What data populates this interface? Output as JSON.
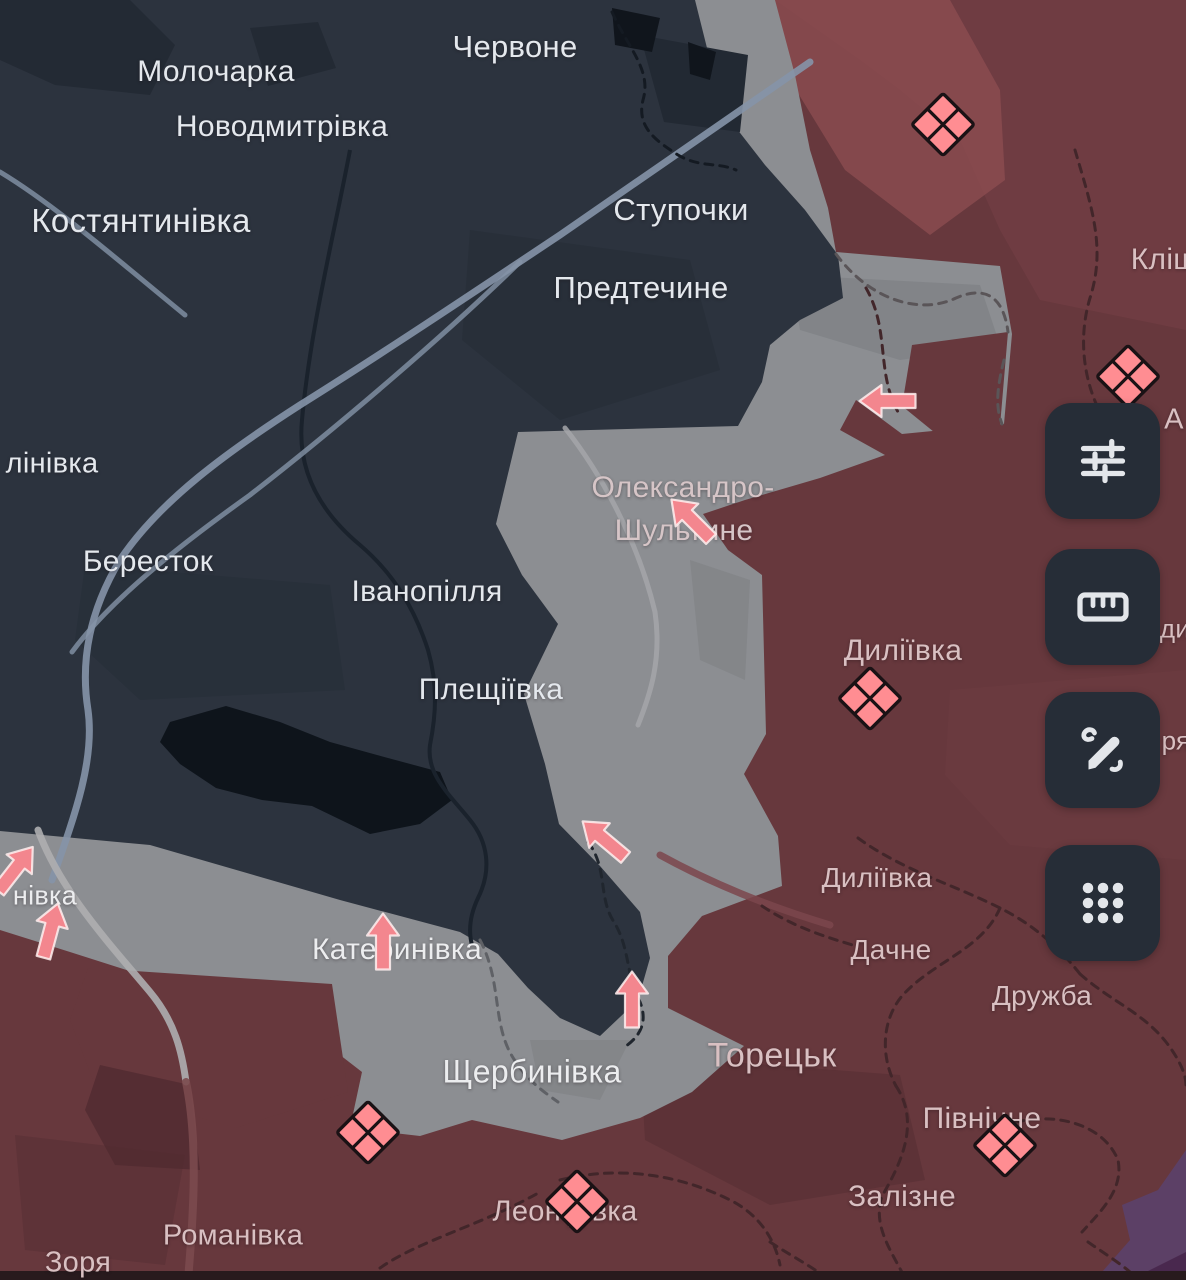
{
  "map": {
    "colors": {
      "ukraine_controlled_navy": "#2c333e",
      "contested_gray": "#8c8e92",
      "russia_controlled_red": "#67383d",
      "recent_advance_red": "#8d4e52",
      "marker_pink": "#ff8d92",
      "marker_outline": "#1a1215",
      "arrow_pink": "#f3868e",
      "purple_region": "#5c4066",
      "button_background": "#262d37",
      "icon_color": "#e3e6ea",
      "road_light": "#8593a8"
    },
    "labels": [
      {
        "name": "chervone",
        "text": "Червоне",
        "x": 515,
        "y": 47,
        "size": 31,
        "tone": "navy"
      },
      {
        "name": "molocharka",
        "text": "Молочарка",
        "x": 216,
        "y": 72,
        "size": 30,
        "tone": "navy"
      },
      {
        "name": "novodmytrivka",
        "text": "Новодмитрівка",
        "x": 282,
        "y": 127,
        "size": 30,
        "tone": "navy"
      },
      {
        "name": "kostiantynivka",
        "text": "Костянтинівка",
        "x": 141,
        "y": 221,
        "size": 33,
        "tone": "navy"
      },
      {
        "name": "stupochky",
        "text": "Ступочки",
        "x": 681,
        "y": 210,
        "size": 31,
        "tone": "navy"
      },
      {
        "name": "predtechyne",
        "text": "Предтечине",
        "x": 641,
        "y": 288,
        "size": 31,
        "tone": "navy"
      },
      {
        "name": "klishchiivka-partial",
        "text": "Кліщі",
        "x": 1168,
        "y": 260,
        "size": 30,
        "tone": "red"
      },
      {
        "name": "kalinivka-partial",
        "text": "лінівка",
        "x": 52,
        "y": 464,
        "size": 29,
        "tone": "navy"
      },
      {
        "name": "berestok",
        "text": "Бересток",
        "x": 148,
        "y": 562,
        "size": 30,
        "tone": "navy"
      },
      {
        "name": "ivanopillia",
        "text": "Іванопілля",
        "x": 427,
        "y": 592,
        "size": 30,
        "tone": "navy"
      },
      {
        "name": "oleksandro-shultyne-line1",
        "text": "Олександро-",
        "x": 683,
        "y": 488,
        "size": 30,
        "tone": "pink"
      },
      {
        "name": "oleksandro-shultyne-line2",
        "text": "Шультине",
        "x": 684,
        "y": 531,
        "size": 30,
        "tone": "pink"
      },
      {
        "name": "pleshchiivka",
        "text": "Плещіївка",
        "x": 491,
        "y": 690,
        "size": 30,
        "tone": "navy"
      },
      {
        "name": "dyliivka-north",
        "text": "Диліївка",
        "x": 903,
        "y": 651,
        "size": 30,
        "tone": "red"
      },
      {
        "name": "dyliivka-south",
        "text": "Диліївка",
        "x": 877,
        "y": 878,
        "size": 28,
        "tone": "red"
      },
      {
        "name": "dachne",
        "text": "Дачне",
        "x": 891,
        "y": 950,
        "size": 28,
        "tone": "red"
      },
      {
        "name": "druzhba",
        "text": "Дружба",
        "x": 1042,
        "y": 996,
        "size": 28,
        "tone": "red"
      },
      {
        "name": "nivka-partial",
        "text": "нівка",
        "x": 45,
        "y": 896,
        "size": 27,
        "tone": "white"
      },
      {
        "name": "katerynivka",
        "text": "Катеринівка",
        "x": 397,
        "y": 950,
        "size": 30,
        "tone": "white"
      },
      {
        "name": "toretsk",
        "text": "Торецьк",
        "x": 772,
        "y": 1056,
        "size": 34,
        "tone": "red"
      },
      {
        "name": "shcherbynivka",
        "text": "Щербинівка",
        "x": 532,
        "y": 1072,
        "size": 32,
        "tone": "white"
      },
      {
        "name": "pivnichne",
        "text": "Північне",
        "x": 982,
        "y": 1119,
        "size": 30,
        "tone": "red"
      },
      {
        "name": "zalizne",
        "text": "Залізне",
        "x": 902,
        "y": 1197,
        "size": 30,
        "tone": "red"
      },
      {
        "name": "leonidivka",
        "text": "Леонідівка",
        "x": 565,
        "y": 1212,
        "size": 29,
        "tone": "red"
      },
      {
        "name": "romanivka",
        "text": "Романівка",
        "x": 233,
        "y": 1236,
        "size": 29,
        "tone": "red"
      },
      {
        "name": "zoria",
        "text": "Зоря",
        "x": 78,
        "y": 1263,
        "size": 29,
        "tone": "red"
      },
      {
        "name": "letter-a-partial",
        "text": "А",
        "x": 1174,
        "y": 420,
        "size": 29,
        "tone": "red"
      },
      {
        "name": "dy-partial",
        "text": "ди",
        "x": 1175,
        "y": 629,
        "size": 26,
        "tone": "red"
      },
      {
        "name": "ria-partial",
        "text": "ря",
        "x": 1176,
        "y": 741,
        "size": 26,
        "tone": "red"
      }
    ],
    "battle_markers": [
      {
        "x": 943,
        "y": 127
      },
      {
        "x": 1128,
        "y": 379
      },
      {
        "x": 870,
        "y": 701
      },
      {
        "x": 368,
        "y": 1135
      },
      {
        "x": 577,
        "y": 1204
      },
      {
        "x": 1005,
        "y": 1148
      }
    ],
    "attack_arrows": [
      {
        "x": 890,
        "y": 401,
        "rot": -90
      },
      {
        "x": 693,
        "y": 521,
        "rot": -45
      },
      {
        "x": 606,
        "y": 841,
        "rot": -50
      },
      {
        "x": 383,
        "y": 944,
        "rot": 0
      },
      {
        "x": 632,
        "y": 1002,
        "rot": 0
      },
      {
        "x": 14,
        "y": 871,
        "rot": 38
      },
      {
        "x": 50,
        "y": 933,
        "rot": 15
      }
    ],
    "toolbar": {
      "buttons": [
        {
          "name": "map-filters-button",
          "icon": "sliders-icon",
          "top": 403
        },
        {
          "name": "measure-button",
          "icon": "ruler-icon",
          "top": 549
        },
        {
          "name": "draw-button",
          "icon": "pen-icon",
          "top": 692
        },
        {
          "name": "apps-button",
          "icon": "apps-grid-icon",
          "top": 845
        }
      ]
    }
  }
}
